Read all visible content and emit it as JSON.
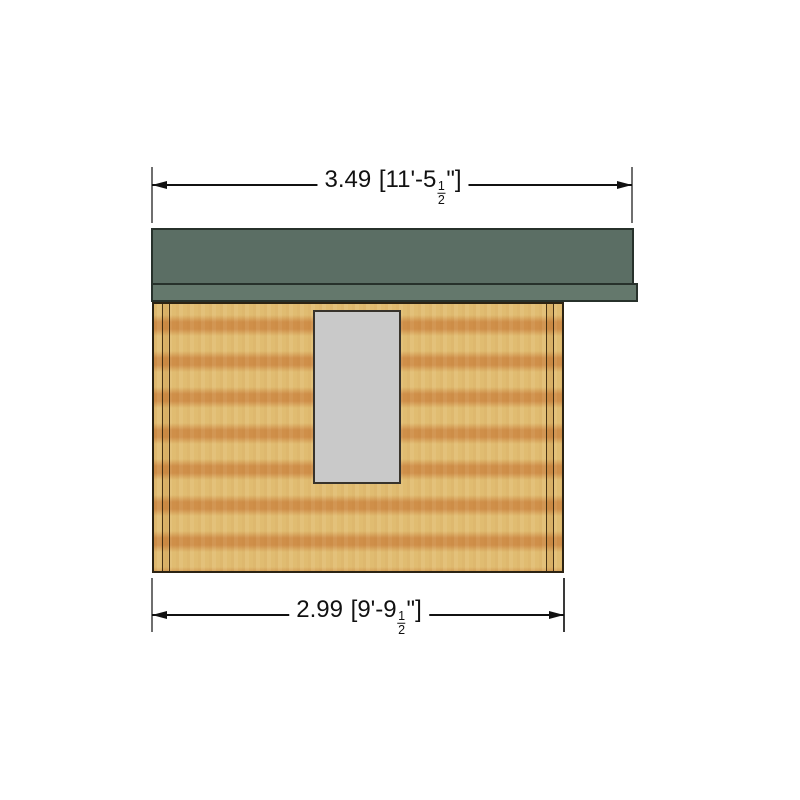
{
  "colors": {
    "background": "#ffffff",
    "roof_green": "#5b6e64",
    "roof_fascia_green": "#64786c",
    "roof_outline": "#27312b",
    "wall_light": "#e2be73",
    "wall_dark": "#d0904a",
    "wall_outline": "#2c2313",
    "window_fill": "#c9c9c9",
    "window_outline": "#38332b",
    "dimension_line": "#111111",
    "extension_line": "#6f6f6f",
    "text": "#111111"
  },
  "dimensions": {
    "top": {
      "metric": "3.49",
      "bracket_open": "[",
      "imperial": "11'-5",
      "fraction_numerator": "1",
      "fraction_denominator": "2",
      "inch_mark": "\"",
      "bracket_close": "]"
    },
    "bottom": {
      "metric": "2.99",
      "bracket_open": "[",
      "imperial": "9'-9",
      "fraction_numerator": "1",
      "fraction_denominator": "2",
      "inch_mark": "\"",
      "bracket_close": "]"
    }
  }
}
